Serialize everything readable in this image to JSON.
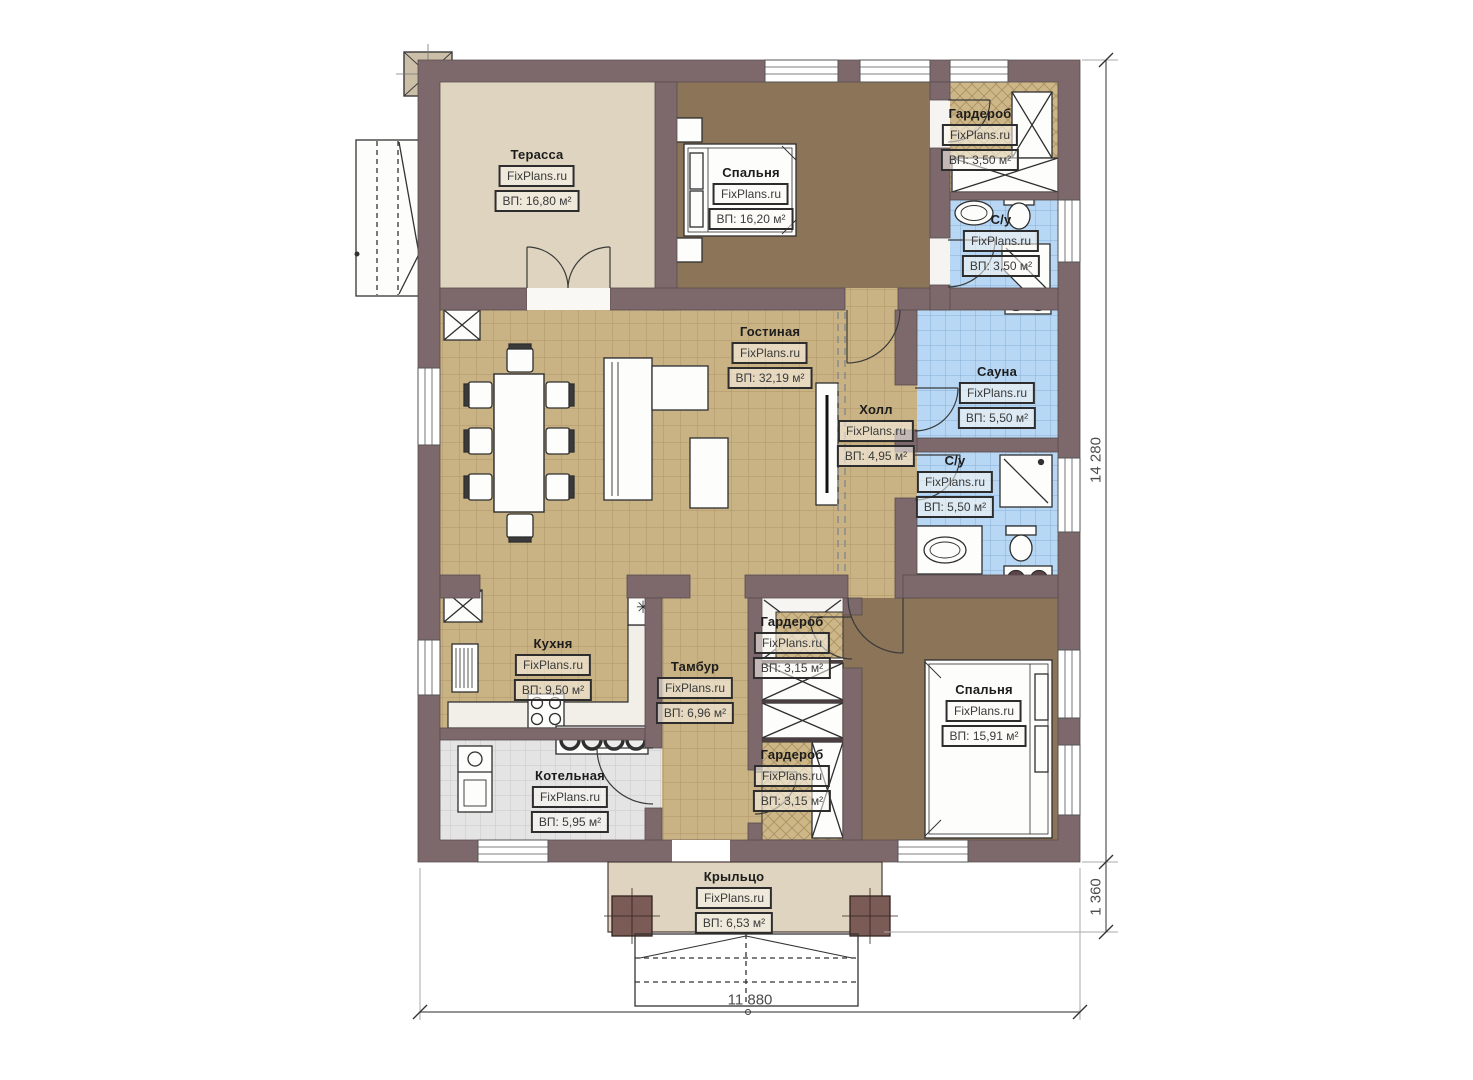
{
  "brand": "FixPlans.ru",
  "rooms": [
    {
      "name": "Терасса",
      "area": "ВП: 16,80 м²"
    },
    {
      "name": "Спальня",
      "area": "ВП: 16,20 м²"
    },
    {
      "name": "Гардероб",
      "area": "ВП: 3,50 м²"
    },
    {
      "name": "С/у",
      "area": "ВП: 3,50 м²"
    },
    {
      "name": "Гостиная",
      "area": "ВП: 32,19 м²"
    },
    {
      "name": "Холл",
      "area": "ВП: 4,95 м²"
    },
    {
      "name": "Сауна",
      "area": "ВП: 5,50 м²"
    },
    {
      "name": "С/у",
      "area": "ВП: 5,50 м²"
    },
    {
      "name": "Кухня",
      "area": "ВП: 9,50 м²"
    },
    {
      "name": "Тамбур",
      "area": "ВП: 6,96 м²"
    },
    {
      "name": "Гардероб",
      "area": "ВП: 3,15 м²"
    },
    {
      "name": "Спальня",
      "area": "ВП: 15,91 м²"
    },
    {
      "name": "Котельная",
      "area": "ВП: 5,95 м²"
    },
    {
      "name": "Гардероб",
      "area": "ВП: 3,15 м²"
    },
    {
      "name": "Крыльцо",
      "area": "ВП: 6,53 м²"
    }
  ],
  "dimensions": {
    "total_height_mm": "14 280",
    "porch_depth_mm": "1 360",
    "total_width_mm": "11 880"
  },
  "colors": {
    "wall": "#7d696b",
    "floor_tile_tan": "#c9b283",
    "floor_tile_blue": "#b7d7f4",
    "floor_terrace_beige": "#ded4bf",
    "floor_bedroom_brown": "#8c7458",
    "floor_boiler_gray": "#e4e4e4"
  }
}
